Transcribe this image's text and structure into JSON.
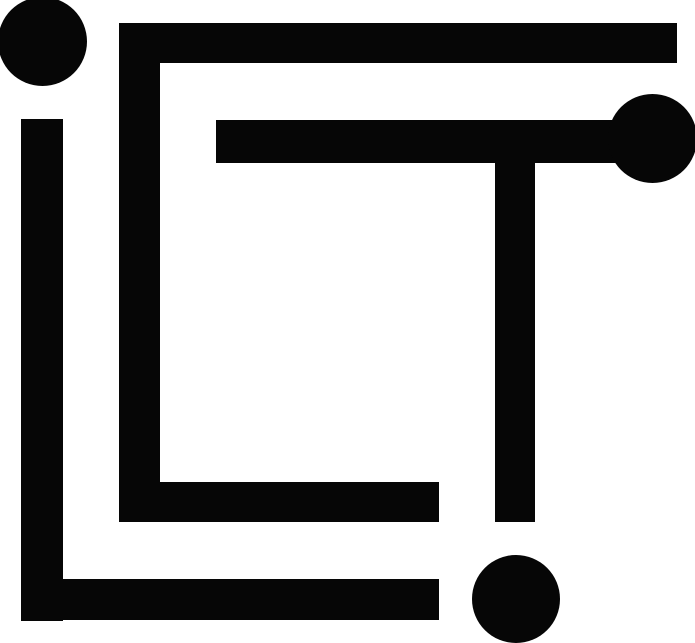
{
  "page": {
    "background_color": "#ffffff"
  },
  "logo": {
    "name": "ICT monogram logo",
    "letters": "ICT",
    "style": "geometric circuit-maze monogram of thick bars and round dots",
    "color": "#060606",
    "canvas": {
      "width": 695,
      "height": 643
    },
    "shapes": [
      {
        "id": "letter-i-dot",
        "type": "circle",
        "x": -2,
        "y": -3,
        "w": 89,
        "h": 89
      },
      {
        "id": "letter-i-l-stem",
        "type": "rect",
        "x": 21,
        "y": 119,
        "w": 42,
        "h": 502
      },
      {
        "id": "letter-l-bottom-bar",
        "type": "rect",
        "x": 21,
        "y": 579,
        "w": 418,
        "h": 41
      },
      {
        "id": "letter-c-vertical",
        "type": "rect",
        "x": 119,
        "y": 23,
        "w": 41,
        "h": 499
      },
      {
        "id": "letter-c-top-bar",
        "type": "rect",
        "x": 119,
        "y": 23,
        "w": 558,
        "h": 40
      },
      {
        "id": "letter-c-bottom-bar",
        "type": "rect",
        "x": 119,
        "y": 482,
        "w": 320,
        "h": 40
      },
      {
        "id": "letter-t-cross-bar",
        "type": "rect",
        "x": 216,
        "y": 120,
        "w": 430,
        "h": 43
      },
      {
        "id": "letter-t-end-dot",
        "type": "circle",
        "x": 608,
        "y": 94,
        "w": 89,
        "h": 89
      },
      {
        "id": "letter-t-stem",
        "type": "rect",
        "x": 495,
        "y": 120,
        "w": 40,
        "h": 402
      },
      {
        "id": "bottom-right-dot",
        "type": "circle",
        "x": 472,
        "y": 555,
        "w": 88,
        "h": 88
      }
    ]
  }
}
